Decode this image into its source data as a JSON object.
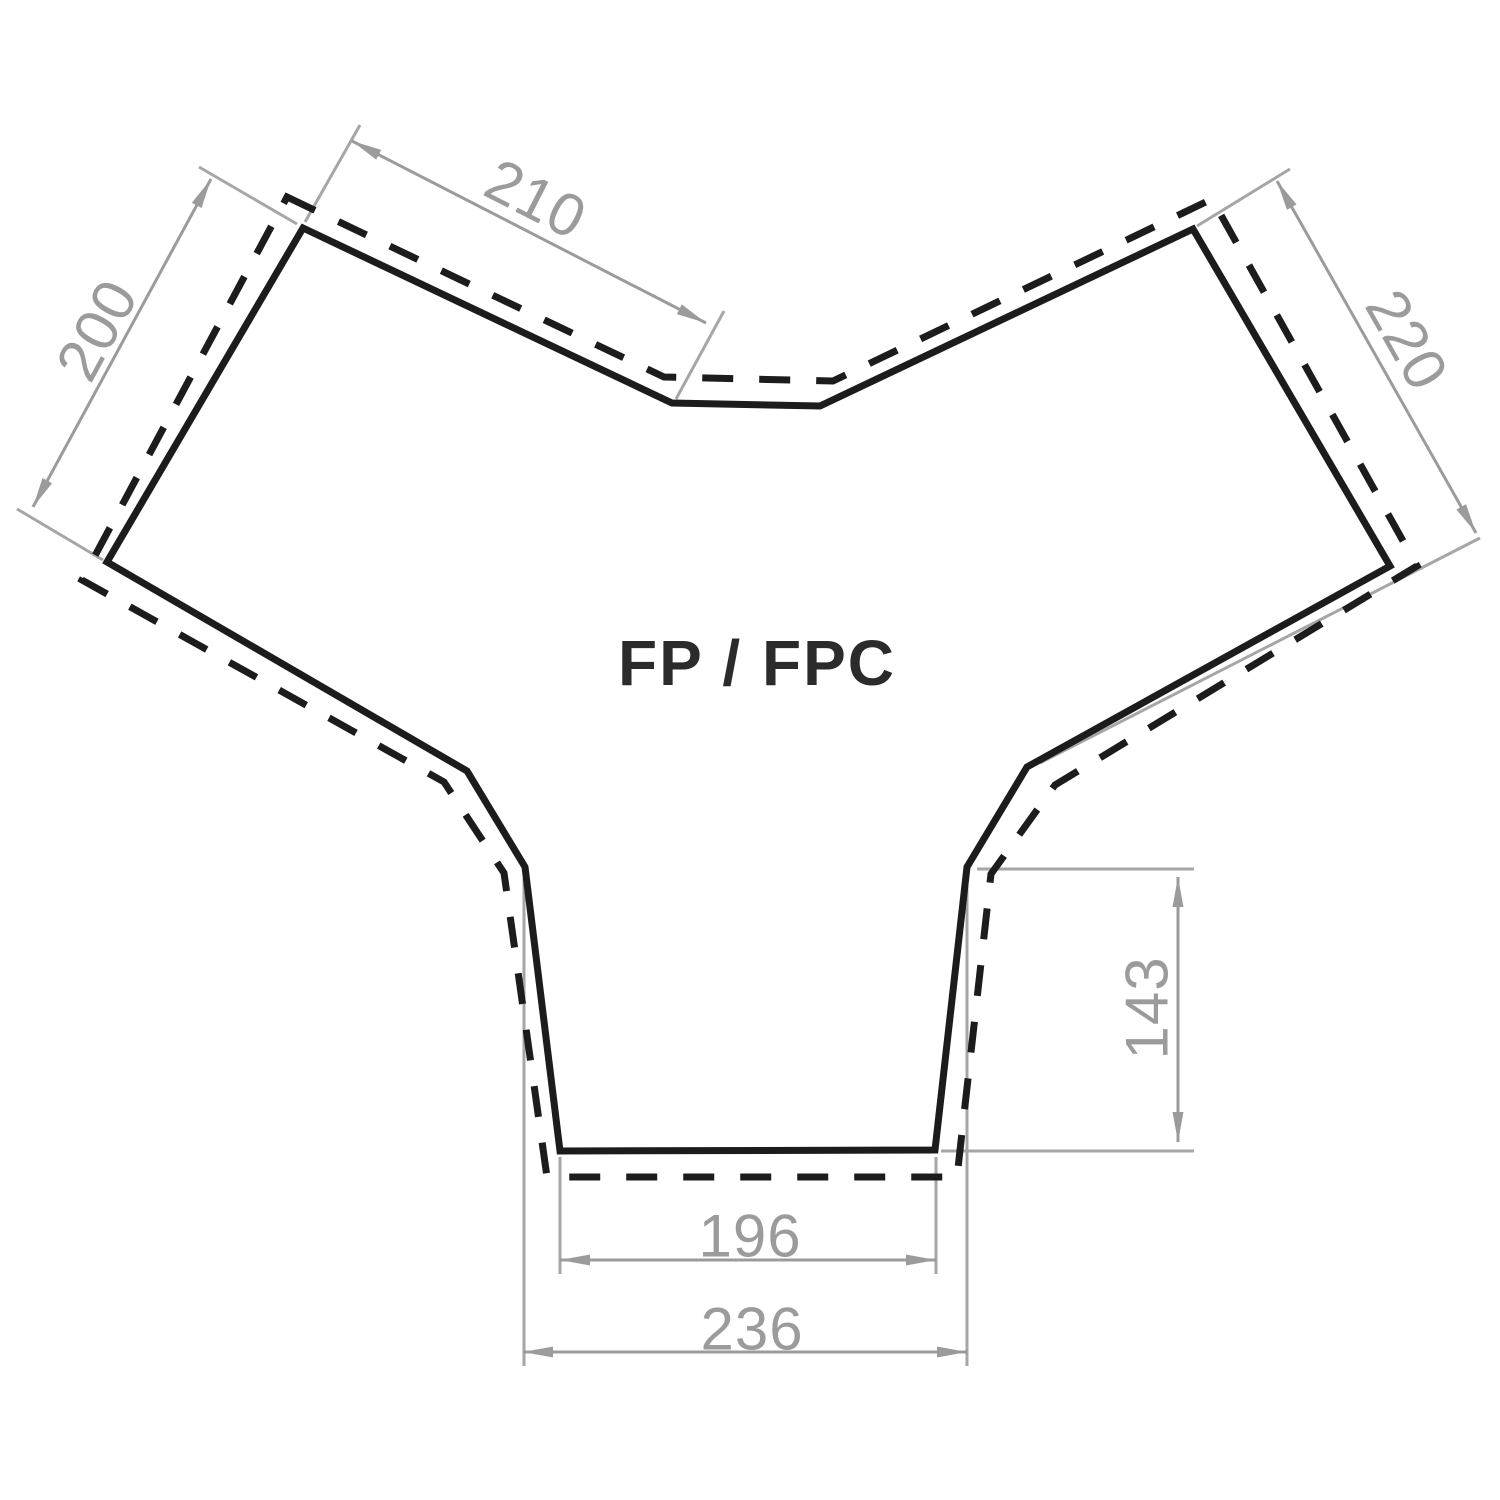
{
  "title": "FP / FPC",
  "colors": {
    "background": "#ffffff",
    "outline": "#1c1c1c",
    "dashed_outline": "#1c1c1c",
    "dimension": "#9b9b9b",
    "extension": "#a6a6a6",
    "title_text": "#2b2b2b"
  },
  "dimensions": [
    {
      "id": "top-left-edge",
      "label": "210"
    },
    {
      "id": "left-edge",
      "label": "200"
    },
    {
      "id": "right-edge",
      "label": "220"
    },
    {
      "id": "right-leg-height",
      "label": "143"
    },
    {
      "id": "bottom-inner-width",
      "label": "196"
    },
    {
      "id": "bottom-outer-width",
      "label": "236"
    }
  ]
}
